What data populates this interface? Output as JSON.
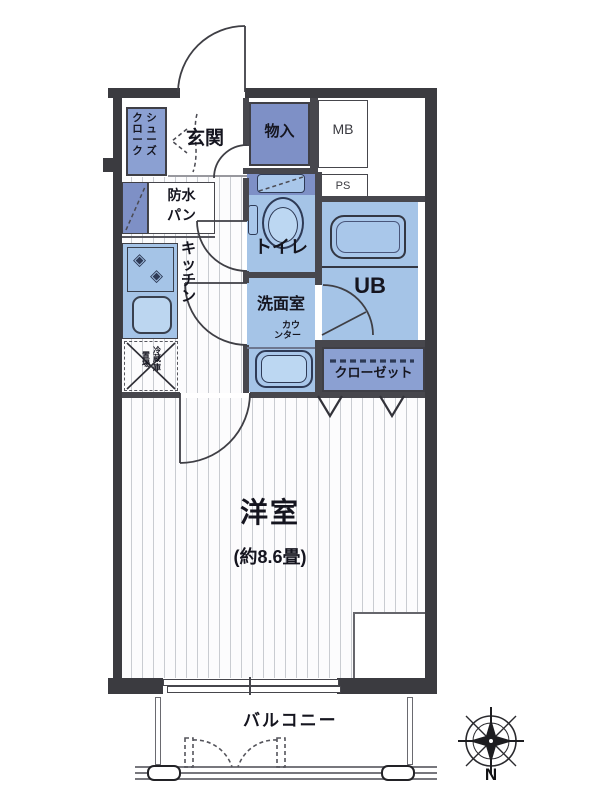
{
  "title": "floor-plan",
  "colors": {
    "room_light_blue": "#a5c4e7",
    "room_medium_blue": "#8ba0d2",
    "room_dark_blue": "#7e90c6",
    "wall": "#3b3b40",
    "fixture_line": "#2e3a56"
  },
  "rooms": {
    "genkan": "玄関",
    "shoe_closet_col_right": "シューズ",
    "shoe_closet_col_left": "クローク",
    "storage": "物入",
    "meter_box": "MB",
    "pipe_space": "PS",
    "waterproof_pan_line1": "防水",
    "waterproof_pan_line2": "パン",
    "kitchen": "キッチン",
    "toilet": "トイレ",
    "unit_bath": "UB",
    "washroom": "洗面室",
    "counter_line1": "カウ",
    "counter_line2": "ンター",
    "closet": "クローゼット",
    "fridge_col_right": "冷蔵庫",
    "fridge_col_left": "置場",
    "western_room": "洋室",
    "western_room_size": "(約8.6畳)",
    "balcony": "バルコニー"
  },
  "compass": {
    "north": "N"
  },
  "icons": {
    "burner": "◈"
  }
}
